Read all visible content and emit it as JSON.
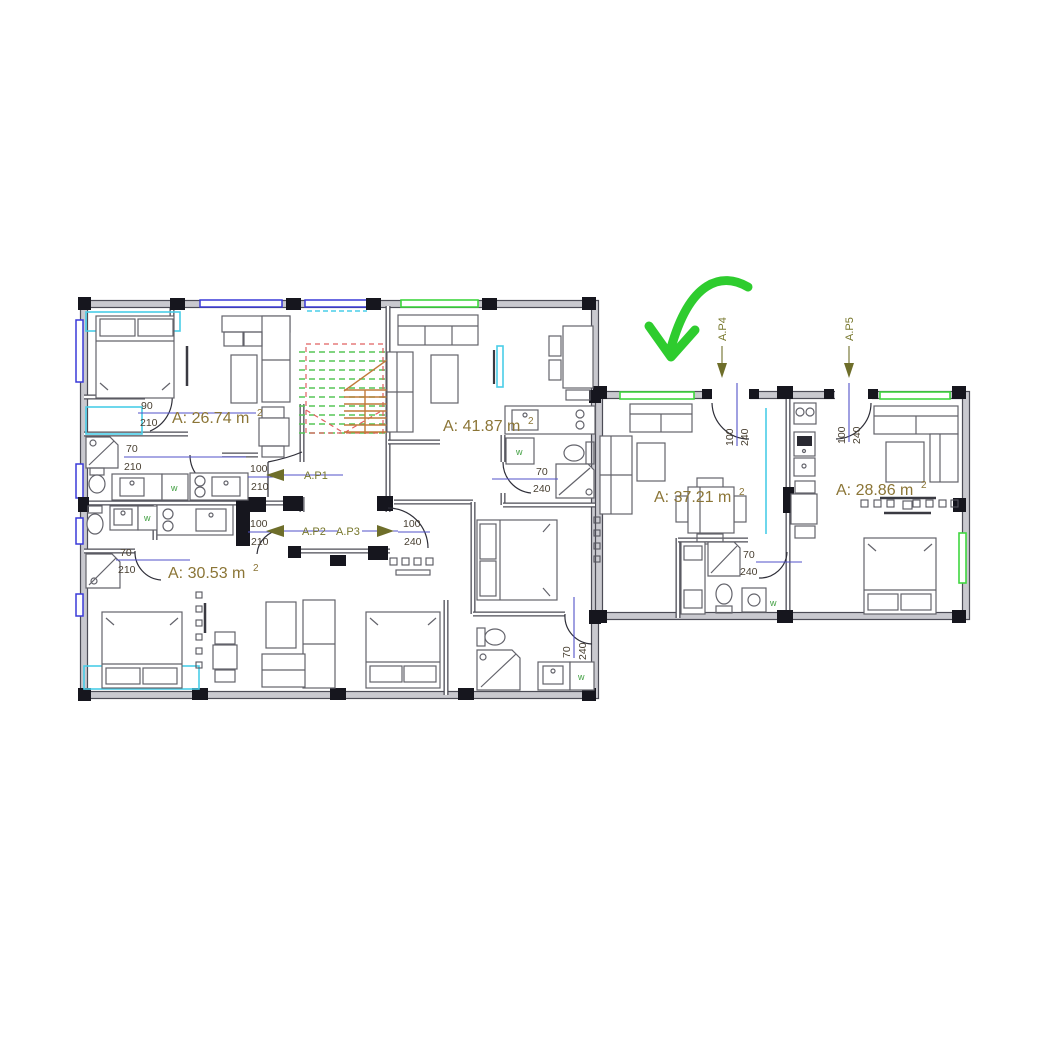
{
  "plan": {
    "areas": [
      {
        "name": "apartment-1",
        "text": "A: 26.74 m",
        "sup": "2"
      },
      {
        "name": "apartment-3",
        "text": "A: 41.87 m",
        "sup": "2"
      },
      {
        "name": "apartment-2",
        "text": "A: 30.53 m",
        "sup": "2"
      },
      {
        "name": "apartment-4",
        "text": "A: 37.21 m",
        "sup": "2"
      },
      {
        "name": "apartment-5",
        "text": "A: 28.86 m",
        "sup": "2"
      }
    ],
    "markers": [
      {
        "label": "A.P1"
      },
      {
        "label": "A.P2"
      },
      {
        "label": "A.P3"
      },
      {
        "label": "A.P4"
      },
      {
        "label": "A.P5"
      }
    ],
    "dimensions": [
      {
        "w": "90",
        "h": "210"
      },
      {
        "w": "70",
        "h": "210"
      },
      {
        "w": "100",
        "h": "210"
      },
      {
        "w": "100",
        "h": "210"
      },
      {
        "w": "100",
        "h": "240"
      },
      {
        "w": "70",
        "h": "210"
      },
      {
        "w": "70",
        "h": "240"
      },
      {
        "w": "70",
        "h": "240"
      },
      {
        "w": "70",
        "h": "240"
      },
      {
        "w": "100",
        "h": "240"
      },
      {
        "w": "100",
        "h": "240"
      }
    ],
    "appliance_label": "w",
    "colors": {
      "wall_band": "#c9c9cf",
      "wall_edge": "#4c4c56",
      "column": "#16161e",
      "furn": "#63636b",
      "dim_line": "#5252c8",
      "dim_text": "#494032",
      "area_text": "#8b7536",
      "marker_text": "#77772c",
      "marker_dark": "#6e6e2a",
      "win_blue": "#3a3ad8",
      "win_green": "#3fd63f",
      "accent_cyan": "#49cde8",
      "stairs_green": "#57c657",
      "stairs_red": "#e06060",
      "stairs_orange": "#c07a3a",
      "green_arrow": "#2ecc2e",
      "w_green": "#3e9e3e"
    }
  }
}
